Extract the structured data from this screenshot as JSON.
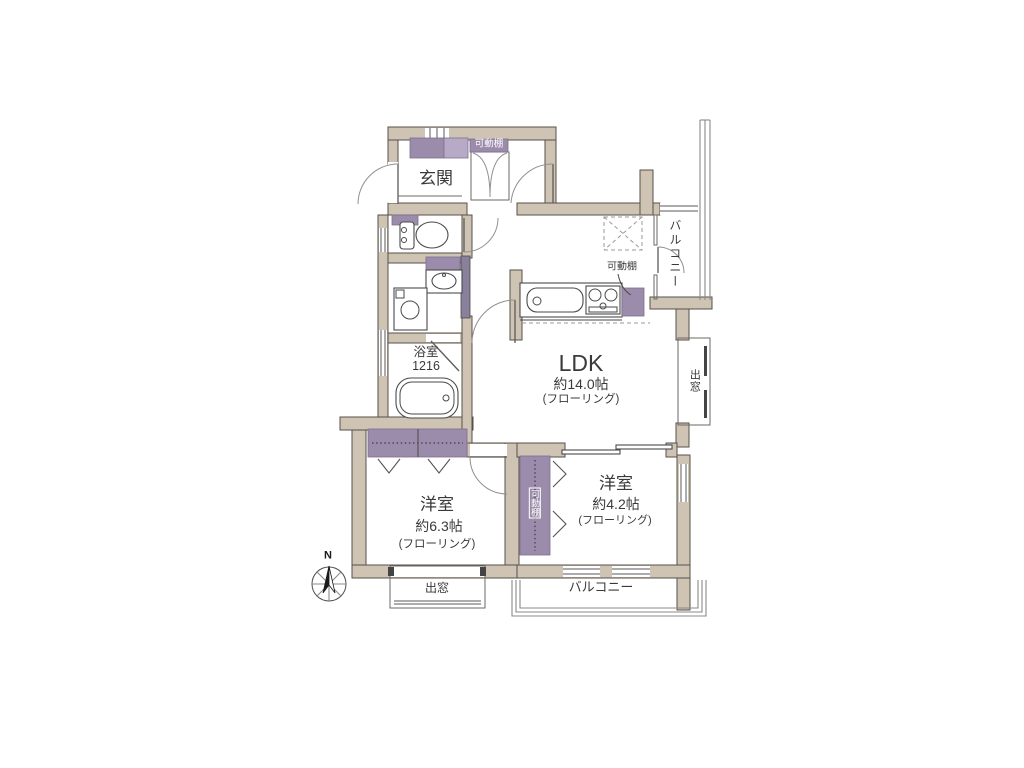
{
  "title": "floor-plan",
  "colors": {
    "wall": "#cfc3b4",
    "wall-stroke": "#57514a",
    "accent": "#9c8cab",
    "accent-light": "#b7aac6"
  },
  "rooms": {
    "entrance": {
      "label": "玄関"
    },
    "ldk": {
      "label": "LDK",
      "size": "約14.0帖",
      "floor": "(フローリング)"
    },
    "bathroom": {
      "label": "浴室",
      "size": "1216"
    },
    "bedroom1": {
      "label": "洋室",
      "size": "約6.3帖",
      "floor": "(フローリング)"
    },
    "bedroom2": {
      "label": "洋室",
      "size": "約4.2帖",
      "floor": "(フローリング)"
    },
    "balcony_top": {
      "label": "バルコニー"
    },
    "balcony_bottom": {
      "label": "バルコニー"
    }
  },
  "features": {
    "shelf_entrance": "可動棚",
    "shelf_kitchen": "可動棚",
    "shelf_closet": "可動棚",
    "bay_window_right": "出窓",
    "bay_window_bottom": "出窓",
    "compass_north": "N"
  }
}
